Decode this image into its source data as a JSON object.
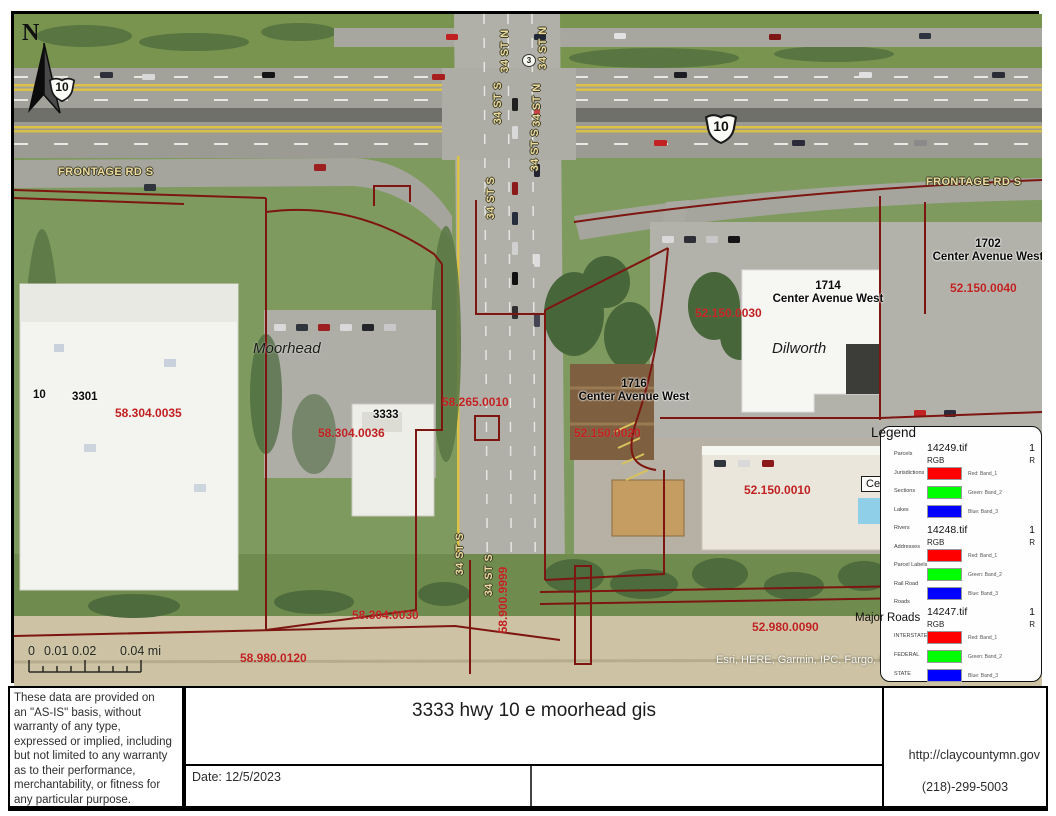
{
  "map": {
    "north_label": "N",
    "junction_badge": "3",
    "highway_shields": [
      "10",
      "10"
    ],
    "street_labels": [
      "FRONTAGE RD S",
      "FRONTAGE RD S",
      "34 ST N",
      "34 ST N",
      "34 ST S",
      "34 ST N",
      "34 ST S",
      "34 ST S",
      "34 ST S",
      "34 ST S"
    ],
    "city_labels": [
      "Moorhead",
      "Dilworth"
    ],
    "addresses": [
      {
        "number": "10",
        "street": ""
      },
      {
        "number": "3301",
        "street": ""
      },
      {
        "number": "3333",
        "street": ""
      },
      {
        "number": "1714",
        "street": "Center Avenue West"
      },
      {
        "number": "1716",
        "street": "Center Avenue West"
      },
      {
        "number": "1702",
        "street": "Center Avenue West"
      }
    ],
    "partial_label": "Cen",
    "parcel_ids": [
      "58.304.0035",
      "58.304.0036",
      "58.265.0010",
      "52.150.0030",
      "52.150.0040",
      "52.150.0020",
      "52.150.0010",
      "58.304.0030",
      "58.900.9999",
      "52.980.0090",
      "58.980.0120"
    ],
    "attribution": "Esri, HERE, Garmin, IPC, Fargo, North",
    "major_roads_label": "Major Roads",
    "scalebar_labels": [
      "0",
      "0.01",
      "0.02",
      "0.04 mi"
    ],
    "colors": {
      "parcel_line": "#7d1511",
      "parcel_text": "#c02020",
      "road_label": "#eddc9e"
    },
    "icons": [
      "north-arrow-icon",
      "us-route-shield-icon"
    ]
  },
  "legend": {
    "title": "Legend",
    "layers": [
      "Parcels",
      "Jurisdictions",
      "Sections",
      "Lakes",
      "Rivers",
      "Addresses",
      "Parcel Labels",
      "Rail Road",
      "Roads"
    ],
    "road_layers": [
      "INTERSTATE",
      "FEDERAL",
      "STATE"
    ],
    "rasters": [
      {
        "name": "14249.tif",
        "count": "1",
        "mode": "RGB",
        "mode_right": "R"
      },
      {
        "name": "14248.tif",
        "count": "1",
        "mode": "RGB",
        "mode_right": "R"
      },
      {
        "name": "14247.tif",
        "count": "1",
        "mode": "RGB",
        "mode_right": "R"
      }
    ],
    "bands": {
      "red": "Red:  Band_1",
      "green": "Green: Band_2",
      "blue": "Blue: Band_3"
    },
    "band_colors": {
      "red": "#ff0000",
      "green": "#00ff00",
      "blue": "#0000ff"
    }
  },
  "footer": {
    "disclaimer": "These data are provided on\nan \"AS-IS\" basis, without\nwarranty of any type,\nexpressed or implied, including\nbut not limited to any warranty\nas to their performance,\nmerchantability, or fitness for\nany particular purpose.",
    "title": "3333 hwy 10 e moorhead gis",
    "date_label": "Date: 12/5/2023",
    "url": "http://claycountymn.gov",
    "phone": "(218)-299-5003"
  }
}
